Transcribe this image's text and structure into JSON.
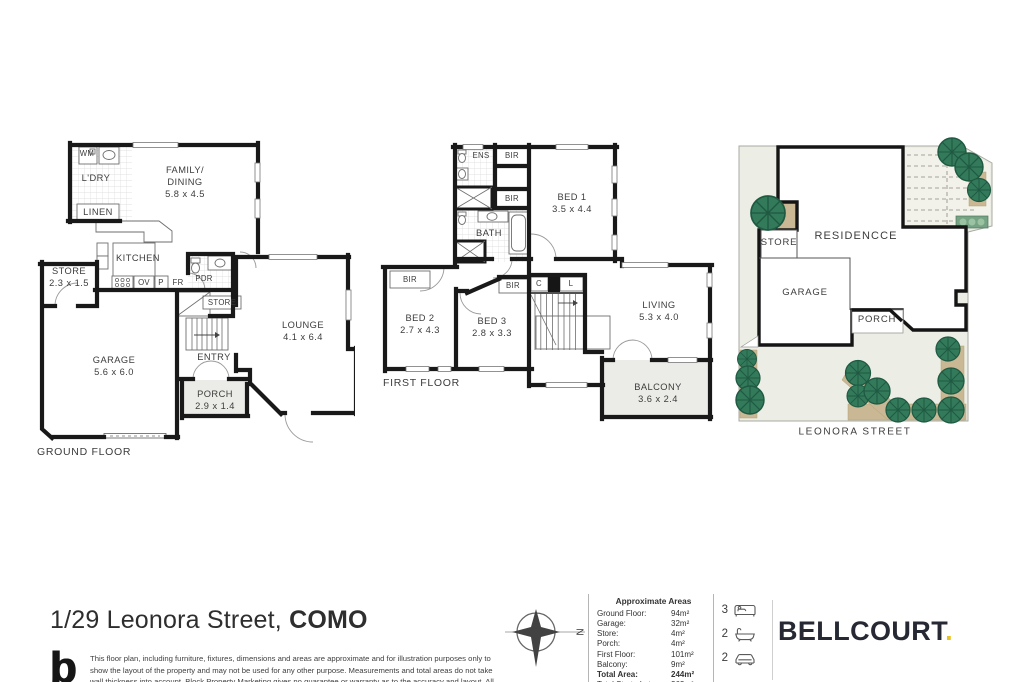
{
  "title": {
    "prefix": "1/29 Leonora Street, ",
    "suffix": "COMO"
  },
  "branding": {
    "agency_logo": "BELLCOURT",
    "agency_logo_dot": ".",
    "maker_logo": "b"
  },
  "disclaimer": "This floor plan, including furniture, fixtures, dimensions and areas are approximate and for illustration purposes only to show the layout of the property and may not be used for any other purpose. Measurements and total areas do not take wall thickness into account. Block Property Marketing gives no guarantee or warranty as to the accuracy and layout. All inquiries must be directed to the agent, vender or party representing this floor plan.",
  "compass": {
    "label": "N"
  },
  "areas": {
    "header": "Approximate Areas",
    "rows": [
      {
        "label": "Ground Floor:",
        "value": "94m²"
      },
      {
        "label": "Garage:",
        "value": "32m²"
      },
      {
        "label": "Store:",
        "value": "4m²"
      },
      {
        "label": "Porch:",
        "value": "4m²"
      },
      {
        "label": "First Floor:",
        "value": "101m²"
      },
      {
        "label": "Balcony:",
        "value": "9m²"
      },
      {
        "label": "Total Area:",
        "value": "244m²"
      },
      {
        "label": "Total Strata Lot:",
        "value": "362m²"
      }
    ]
  },
  "features": [
    {
      "count": "3",
      "icon": "bed"
    },
    {
      "count": "2",
      "icon": "bath"
    },
    {
      "count": "2",
      "icon": "car"
    }
  ],
  "ground": {
    "floor_label": "GROUND FLOOR",
    "labels": {
      "wm": "WM",
      "ldry": "L'DRY",
      "linen": "LINEN",
      "family_dining": "FAMILY/\nDINING\n5.8 x 4.5",
      "kitchen": "KITCHEN",
      "store": "STORE\n2.3 x 1.5",
      "ov": "OV",
      "p": "P",
      "fr": "FR",
      "pdr": "PDR",
      "store_under_stairs": "STORE",
      "garage": "GARAGE\n5.6 x 6.0",
      "entry": "ENTRY",
      "porch": "PORCH\n2.9 x 1.4",
      "lounge": "LOUNGE\n4.1 x 6.4"
    }
  },
  "first": {
    "floor_label": "FIRST FLOOR",
    "labels": {
      "ens": "ENS",
      "bir_top": "BIR",
      "bir_mid": "BIR",
      "bir_left": "BIR",
      "bir_bed3": "BIR",
      "bed1": "BED 1\n3.5 x 4.4",
      "bath": "BATH",
      "c": "C",
      "l": "L",
      "bed2": "BED 2\n2.7 x 4.3",
      "bed3": "BED 3\n2.8 x 3.3",
      "living": "LIVING\n5.3 x 4.0",
      "balcony": "BALCONY\n3.6 x 2.4"
    }
  },
  "site": {
    "labels": {
      "residence": "RESIDENCCE",
      "store": "STORE",
      "garage": "GARAGE",
      "porch": "PORCH",
      "street": "LEONORA STREET"
    }
  },
  "colors": {
    "wall_black": "#191919",
    "porch_fill": "#ebebe7",
    "site_fill": "#ecede4",
    "tree_green": "#337a5b",
    "planter_tan": "#c9b893",
    "bellcourt_navy": "#262833",
    "bellcourt_gold": "#e9c31f"
  }
}
